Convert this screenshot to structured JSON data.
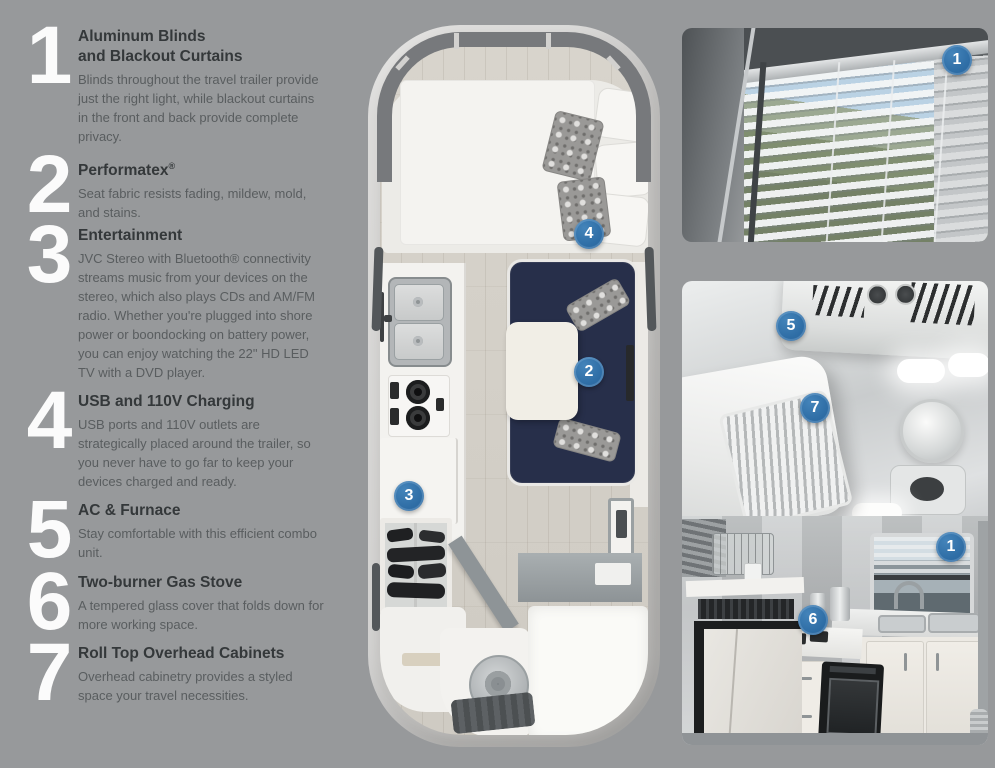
{
  "page": {
    "background": "#97999b"
  },
  "colors": {
    "badge_blue": "#3374ab",
    "sofa_navy": "#272f4a",
    "shell_gray": "#c6c5c3"
  },
  "features": [
    {
      "num": "1",
      "title": "Aluminum Blinds\nand Blackout Curtains",
      "desc": "Blinds throughout the travel trailer provide just the right light, while blackout curtains in the front and back provide complete privacy."
    },
    {
      "num": "2",
      "title": "Performatex",
      "title_sup": "®",
      "desc": "Seat fabric resists fading, mildew, mold, and stains."
    },
    {
      "num": "3",
      "title": "Entertainment",
      "desc": "JVC Stereo with Bluetooth® connectivity streams music from your devices on the stereo, which also plays CDs and AM/FM radio. Whether you're plugged into shore power or boondocking on battery power, you can enjoy watching the 22\" HD LED TV with a DVD player."
    },
    {
      "num": "4",
      "title": "USB and 110V Charging",
      "desc": "USB ports and 110V outlets are strategically placed around the trailer, so you never have to go far to keep your devices charged and ready."
    },
    {
      "num": "5",
      "title": "AC & Furnace",
      "desc": "Stay comfortable with this efficient combo unit."
    },
    {
      "num": "6",
      "title": "Two-burner Gas Stove",
      "desc": "A tempered glass cover that folds down for more working space."
    },
    {
      "num": "7",
      "title": "Roll Top Overhead Cabinets",
      "desc": "Overhead cabinetry provides a styled space your travel necessities."
    }
  ],
  "floorplan": {
    "badge_sofa": "2",
    "badge_cabinet": "3",
    "badge_charging": "4"
  },
  "photo_blinds": {
    "badge_window": "1"
  },
  "photo_interior": {
    "badge_ac": "5",
    "badge_rolltop": "7",
    "badge_stove": "6",
    "badge_window": "1"
  }
}
